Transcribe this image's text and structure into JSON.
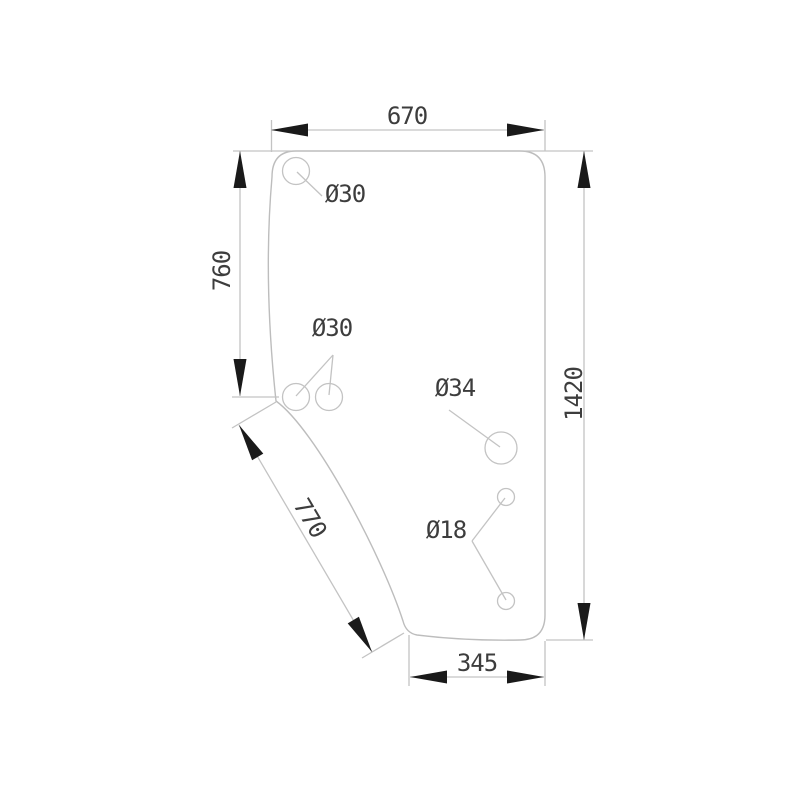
{
  "drawing": {
    "dim_width_top": "670",
    "dim_height_left": "760",
    "dim_height_right": "1420",
    "dim_diagonal": "770",
    "dim_width_bottom": "345",
    "hole_top_left_label": "Ø30",
    "hole_mid_pair_label": "Ø30",
    "hole_center_label": "Ø34",
    "hole_small_pair_label": "Ø18",
    "colors": {
      "line": "#c3c3c3",
      "arrow": "#1a1a1a",
      "text": "#3d3d3d",
      "background": "#ffffff"
    }
  }
}
